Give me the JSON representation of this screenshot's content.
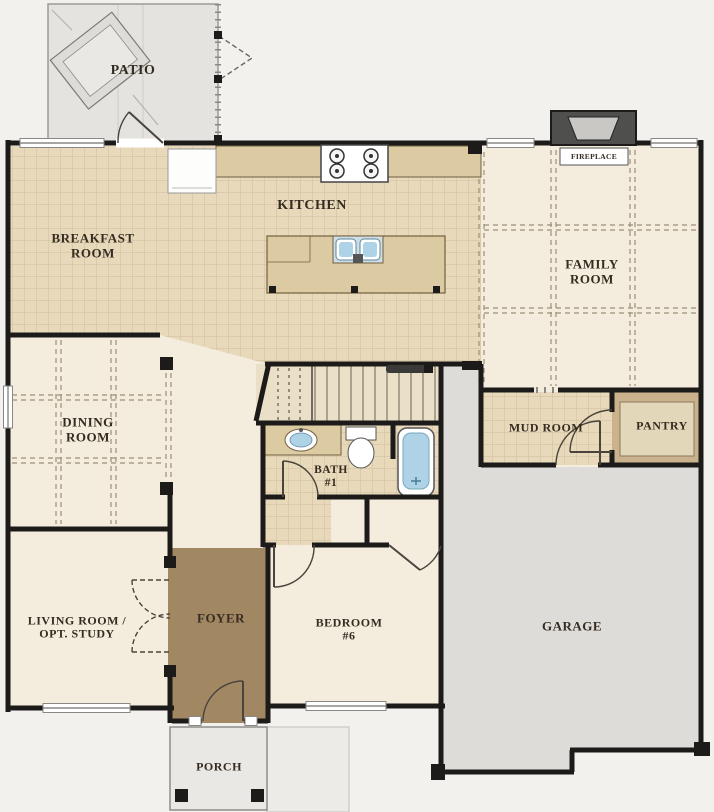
{
  "rooms": {
    "patio": {
      "label": "PATIO"
    },
    "breakfast": {
      "line1": "BREAKFAST",
      "line2": "ROOM"
    },
    "kitchen": {
      "label": "KITCHEN"
    },
    "family": {
      "line1": "FAMILY",
      "line2": "ROOM"
    },
    "fireplace": {
      "label": "FIREPLACE"
    },
    "dining": {
      "line1": "DINING",
      "line2": "ROOM"
    },
    "mudroom": {
      "label": "MUD ROOM"
    },
    "pantry": {
      "label": "PANTRY"
    },
    "bath1": {
      "line1": "BATH",
      "line2": "#1"
    },
    "living": {
      "line1": "LIVING ROOM /",
      "line2": "OPT. STUDY"
    },
    "foyer": {
      "label": "FOYER"
    },
    "bedroom6": {
      "line1": "BEDROOM",
      "line2": "#6"
    },
    "garage": {
      "label": "GARAGE"
    },
    "porch": {
      "label": "PORCH"
    }
  },
  "fixtures": {
    "grill": "outdoor-grill",
    "stove": "4-burner-cooktop",
    "refrigerator": "fridge-box",
    "kitchen_sink": "double-basin-sink",
    "vanity_sink": "oval-sink",
    "toilet": "toilet",
    "bathtub": "tub",
    "fireplace": "hearth",
    "stairs": "staircase-up",
    "handrail": "stair-rail"
  },
  "colors": {
    "wall": "#1d1b19",
    "cream": "#f4edde",
    "tile_base": "#e8d9bb",
    "tile_line": "#cebc9b",
    "patio": "#e4e3e0",
    "garage": "#dedcd8",
    "porch": "#e9e8e5",
    "walkway": "#edebe7",
    "foyer": "#a28763",
    "pantry": "#c9b28c",
    "pantry_shelf": "#e3d7ba",
    "counter": "#dccaa3",
    "counter_line": "#71603f",
    "fixture_blue": "#aed3e6",
    "stairs": "#eadfc7",
    "label": "#352c21",
    "dash": "#9a8f78"
  }
}
